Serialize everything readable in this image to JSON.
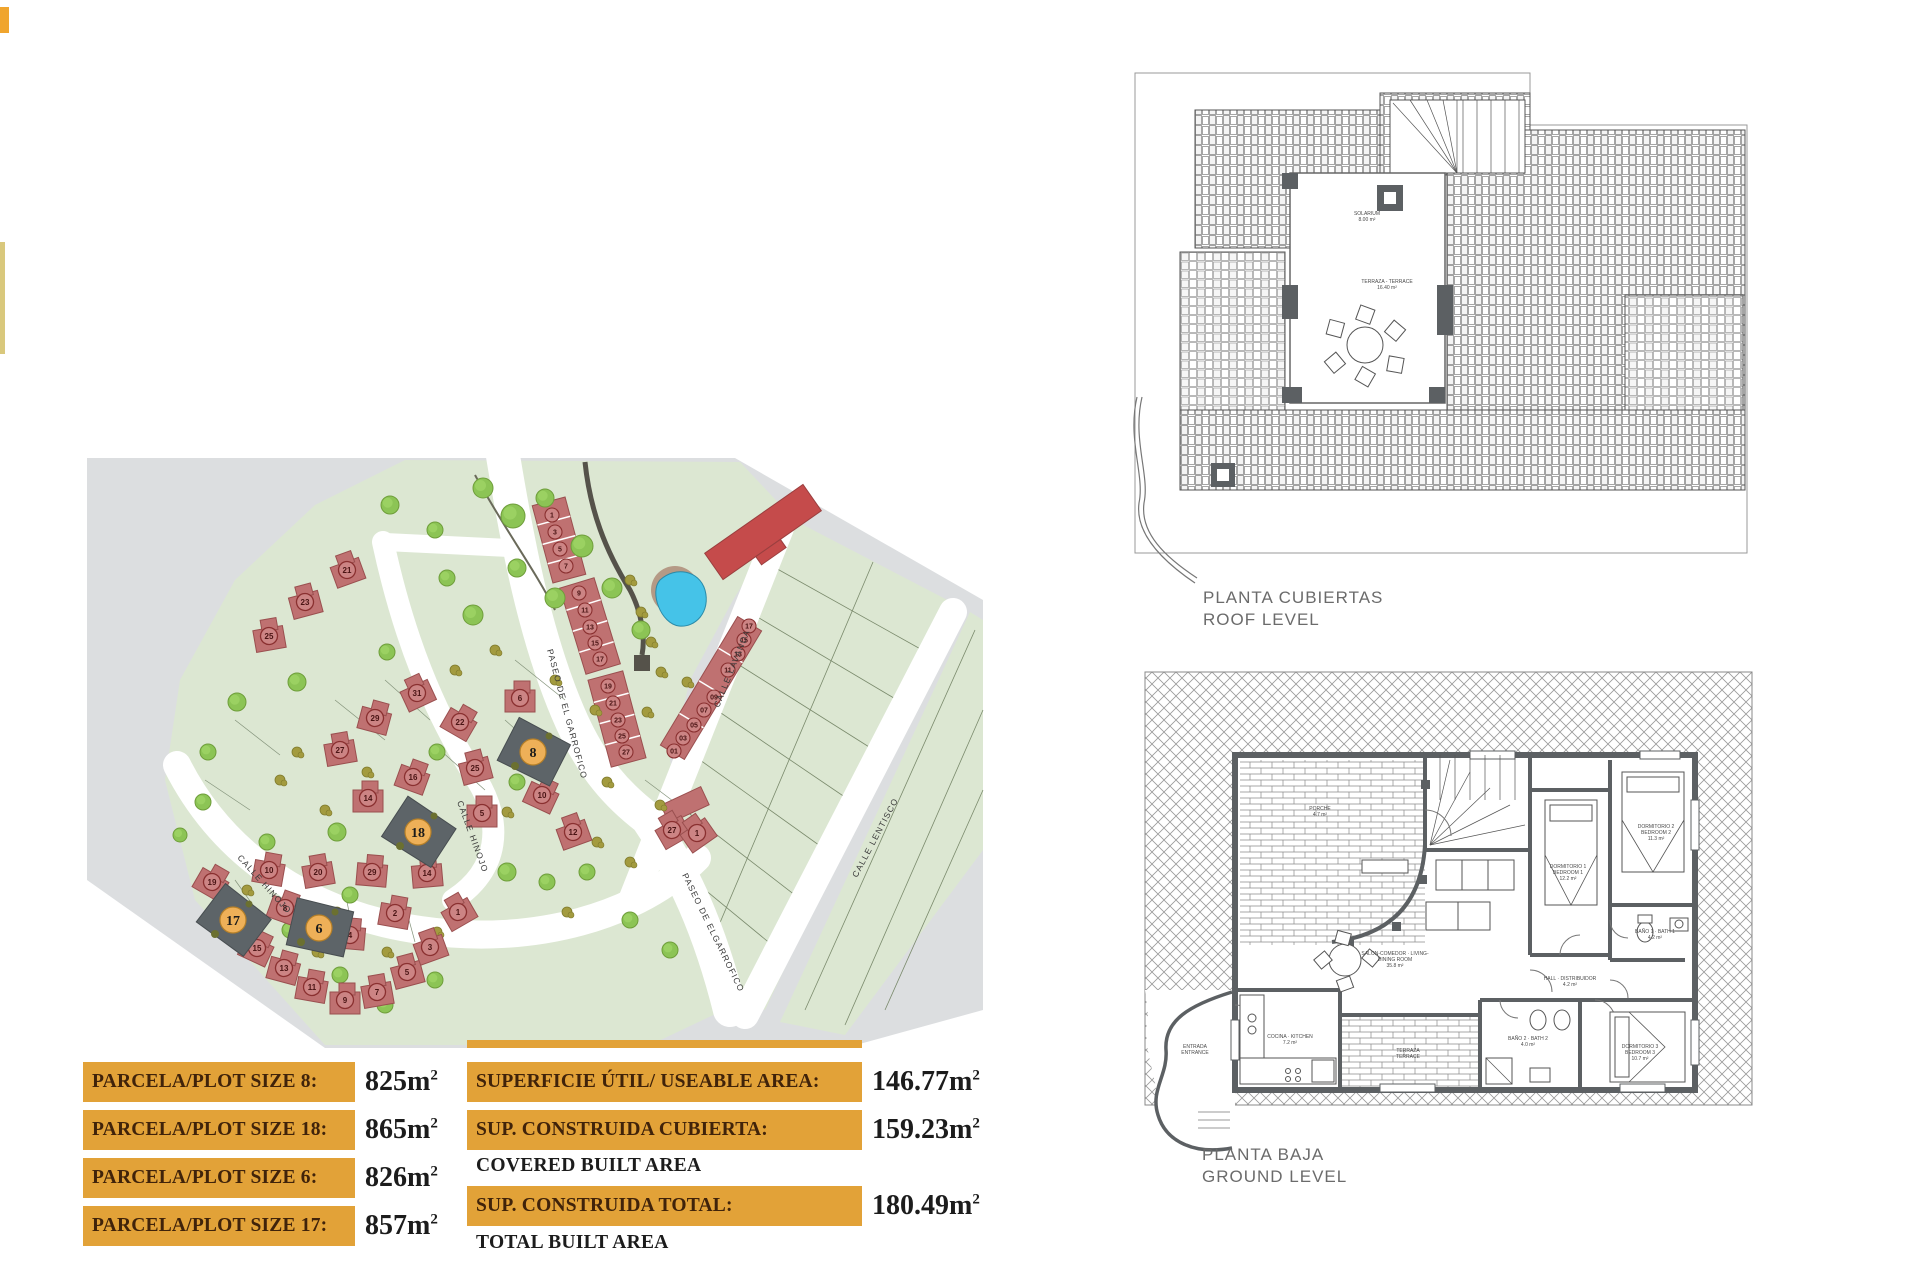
{
  "colors": {
    "orange": "#e2a238",
    "map_gray": "#dcdee0",
    "plot_green": "#dce7d2",
    "street_white": "#ffffff",
    "house_red": "#bf7171",
    "house_red_dark": "#9a4f4f",
    "number_ring": "#8a3030",
    "number_fill": "#cc8484",
    "highlight_gray": "#5d6468",
    "highlight_orange": "#eeb058",
    "pool_blue": "#45c3e8",
    "deck_tan": "#b59a86",
    "tree_green": "#8cc455",
    "tree_green_dark": "#6f9e3b",
    "shrub_olive": "#a39b3f",
    "wall_gray": "#5c6063",
    "park_path": "#55524a"
  },
  "site_plan": {
    "streets": [
      {
        "label": "PASEO DE EL GARROFICO",
        "x": 462,
        "y": 200,
        "rot": 75
      },
      {
        "label": "PASEO DE ELGARROFICO",
        "x": 597,
        "y": 425,
        "rot": 64
      },
      {
        "label": "CALLE LAVANDA",
        "x": 634,
        "y": 258,
        "rot": -68
      },
      {
        "label": "CALLE LENTISCO",
        "x": 772,
        "y": 428,
        "rot": -62
      },
      {
        "label": "CALLE HINOJO",
        "x": 152,
        "y": 408,
        "rot": 48
      },
      {
        "label": "CALLE HINOJO",
        "x": 372,
        "y": 352,
        "rot": 70
      }
    ],
    "highlighted_plots": [
      {
        "n": "8",
        "x": 448,
        "y": 302,
        "rot": 32
      },
      {
        "n": "18",
        "x": 333,
        "y": 382,
        "rot": 38
      },
      {
        "n": "6",
        "x": 234,
        "y": 478,
        "rot": 18
      },
      {
        "n": "17",
        "x": 148,
        "y": 470,
        "rot": 42
      }
    ],
    "villas": [
      {
        "n": "31",
        "x": 332,
        "y": 243,
        "rot": -25
      },
      {
        "n": "29",
        "x": 290,
        "y": 268,
        "rot": 15
      },
      {
        "n": "27",
        "x": 255,
        "y": 300,
        "rot": -10
      },
      {
        "n": "16",
        "x": 328,
        "y": 327,
        "rot": 20
      },
      {
        "n": "14",
        "x": 283,
        "y": 348,
        "rot": 0
      },
      {
        "n": "22",
        "x": 375,
        "y": 272,
        "rot": 30
      },
      {
        "n": "6",
        "x": 435,
        "y": 248,
        "rot": 0
      },
      {
        "n": "25",
        "x": 390,
        "y": 318,
        "rot": -15
      },
      {
        "n": "10",
        "x": 457,
        "y": 345,
        "rot": 25
      },
      {
        "n": "5",
        "x": 397,
        "y": 363,
        "rot": 0
      },
      {
        "n": "12",
        "x": 488,
        "y": 382,
        "rot": -20
      },
      {
        "n": "10",
        "x": 184,
        "y": 420,
        "rot": 10
      },
      {
        "n": "20",
        "x": 233,
        "y": 422,
        "rot": -10
      },
      {
        "n": "29",
        "x": 287,
        "y": 422,
        "rot": 5
      },
      {
        "n": "14",
        "x": 342,
        "y": 423,
        "rot": -5
      },
      {
        "n": "19",
        "x": 127,
        "y": 432,
        "rot": 30
      },
      {
        "n": "15",
        "x": 172,
        "y": 498,
        "rot": 25
      },
      {
        "n": "13",
        "x": 199,
        "y": 518,
        "rot": 15
      },
      {
        "n": "11",
        "x": 227,
        "y": 537,
        "rot": 10
      },
      {
        "n": "9",
        "x": 260,
        "y": 550,
        "rot": 0
      },
      {
        "n": "7",
        "x": 292,
        "y": 542,
        "rot": -10
      },
      {
        "n": "5",
        "x": 322,
        "y": 522,
        "rot": -15
      },
      {
        "n": "3",
        "x": 345,
        "y": 497,
        "rot": -20
      },
      {
        "n": "1",
        "x": 373,
        "y": 462,
        "rot": -30
      },
      {
        "n": "2",
        "x": 310,
        "y": 463,
        "rot": 10
      },
      {
        "n": "4",
        "x": 265,
        "y": 485,
        "rot": 5
      },
      {
        "n": "8",
        "x": 200,
        "y": 458,
        "rot": 20
      },
      {
        "n": "27",
        "x": 587,
        "y": 380,
        "rot": -30
      },
      {
        "n": "1",
        "x": 612,
        "y": 383,
        "rot": -35
      },
      {
        "n": "21",
        "x": 262,
        "y": 120,
        "rot": -20
      },
      {
        "n": "23",
        "x": 220,
        "y": 152,
        "rot": -15
      },
      {
        "n": "25",
        "x": 184,
        "y": 186,
        "rot": -10
      }
    ],
    "townhouse_numbers": [
      {
        "n": "1",
        "x": 467,
        "y": 65
      },
      {
        "n": "3",
        "x": 470,
        "y": 82
      },
      {
        "n": "5",
        "x": 475,
        "y": 99
      },
      {
        "n": "7",
        "x": 481,
        "y": 116
      },
      {
        "n": "9",
        "x": 494,
        "y": 143
      },
      {
        "n": "11",
        "x": 500,
        "y": 160
      },
      {
        "n": "13",
        "x": 505,
        "y": 177
      },
      {
        "n": "15",
        "x": 510,
        "y": 193
      },
      {
        "n": "17",
        "x": 515,
        "y": 209
      },
      {
        "n": "19",
        "x": 523,
        "y": 236
      },
      {
        "n": "21",
        "x": 528,
        "y": 253
      },
      {
        "n": "23",
        "x": 533,
        "y": 270
      },
      {
        "n": "25",
        "x": 537,
        "y": 286
      },
      {
        "n": "27",
        "x": 541,
        "y": 302
      },
      {
        "n": "17",
        "x": 664,
        "y": 176
      },
      {
        "n": "15",
        "x": 659,
        "y": 190
      },
      {
        "n": "13",
        "x": 653,
        "y": 204
      },
      {
        "n": "11",
        "x": 643,
        "y": 220
      },
      {
        "n": "09",
        "x": 629,
        "y": 247
      },
      {
        "n": "07",
        "x": 619,
        "y": 260
      },
      {
        "n": "05",
        "x": 609,
        "y": 275
      },
      {
        "n": "03",
        "x": 598,
        "y": 288
      },
      {
        "n": "01",
        "x": 589,
        "y": 301
      }
    ],
    "trees": [
      [
        398,
        38,
        10
      ],
      [
        428,
        66,
        12
      ],
      [
        460,
        48,
        9
      ],
      [
        497,
        96,
        11
      ],
      [
        527,
        138,
        10
      ],
      [
        556,
        180,
        9
      ],
      [
        470,
        148,
        10
      ],
      [
        432,
        118,
        9
      ],
      [
        388,
        165,
        10
      ],
      [
        362,
        128,
        8
      ],
      [
        305,
        55,
        9
      ],
      [
        350,
        80,
        8
      ],
      [
        152,
        252,
        9
      ],
      [
        123,
        302,
        8
      ],
      [
        212,
        232,
        9
      ],
      [
        302,
        202,
        8
      ],
      [
        252,
        382,
        9
      ],
      [
        182,
        392,
        8
      ],
      [
        352,
        302,
        8
      ],
      [
        422,
        422,
        9
      ],
      [
        462,
        432,
        8
      ],
      [
        502,
        422,
        8
      ],
      [
        118,
        352,
        8
      ],
      [
        265,
        445,
        8
      ],
      [
        432,
        332,
        8
      ],
      [
        95,
        385,
        7
      ],
      [
        545,
        470,
        8
      ],
      [
        585,
        500,
        8
      ],
      [
        300,
        555,
        8
      ],
      [
        350,
        530,
        8
      ],
      [
        255,
        525,
        8
      ],
      [
        205,
        480,
        8
      ]
    ],
    "shrubs": [
      [
        162,
        440
      ],
      [
        252,
        462
      ],
      [
        332,
        402
      ],
      [
        422,
        362
      ],
      [
        522,
        332
      ],
      [
        562,
        262
      ],
      [
        602,
        232
      ],
      [
        212,
        302
      ],
      [
        282,
        322
      ],
      [
        382,
        262
      ],
      [
        442,
        282
      ],
      [
        302,
        502
      ],
      [
        352,
        482
      ],
      [
        232,
        502
      ],
      [
        482,
        462
      ],
      [
        512,
        392
      ],
      [
        575,
        355
      ],
      [
        545,
        412
      ],
      [
        470,
        230
      ],
      [
        510,
        260
      ],
      [
        410,
        200
      ],
      [
        370,
        220
      ],
      [
        330,
        250
      ],
      [
        290,
        350
      ],
      [
        240,
        360
      ],
      [
        195,
        330
      ],
      [
        545,
        130
      ],
      [
        556,
        162
      ],
      [
        566,
        192
      ],
      [
        576,
        222
      ]
    ]
  },
  "roof_plan": {
    "title_es": "PLANTA CUBIERTAS",
    "title_en": "ROOF LEVEL",
    "labels": [
      {
        "x": 242,
        "y": 170,
        "lines": [
          "SOLARIUM",
          "8.00 m²"
        ]
      },
      {
        "x": 262,
        "y": 238,
        "lines": [
          "TERRAZA - TERRACE",
          "16.40 m²"
        ]
      }
    ]
  },
  "ground_plan": {
    "title_es": "PLANTA BAJA",
    "title_en": "GROUND LEVEL",
    "labels": [
      {
        "x": 255,
        "y": 295,
        "lines": [
          "SALON-COMEDOR · LIVING-",
          "DINING ROOM",
          "35.8 m²"
        ]
      },
      {
        "x": 428,
        "y": 208,
        "lines": [
          "DORMITORIO 1",
          "BEDROOM 1",
          "12.2 m²"
        ]
      },
      {
        "x": 516,
        "y": 168,
        "lines": [
          "DORMITORIO 2",
          "BEDROOM 2",
          "11.3 m²"
        ]
      },
      {
        "x": 515,
        "y": 273,
        "lines": [
          "BAÑO 1 · BATH 1",
          "4.2 m²"
        ]
      },
      {
        "x": 430,
        "y": 320,
        "lines": [
          "HALL · DISTRIBUIDOR",
          "4.2 m²"
        ]
      },
      {
        "x": 388,
        "y": 380,
        "lines": [
          "BAÑO 2 · BATH 2",
          "4.0 m²"
        ]
      },
      {
        "x": 500,
        "y": 388,
        "lines": [
          "DORMITORIO 3",
          "BEDROOM 3",
          "10.7 m²"
        ]
      },
      {
        "x": 150,
        "y": 378,
        "lines": [
          "COCINA · KITCHEN",
          "7.2 m²"
        ]
      },
      {
        "x": 268,
        "y": 392,
        "lines": [
          "TERRAZA",
          "TERRACE"
        ]
      },
      {
        "x": 55,
        "y": 388,
        "lines": [
          "ENTRADA",
          "ENTRANCE"
        ]
      },
      {
        "x": 180,
        "y": 150,
        "lines": [
          "PORCHE",
          "4.7 m²"
        ]
      }
    ]
  },
  "plot_table": {
    "unit": "m",
    "sup": "2",
    "rows": [
      {
        "label": "PARCELA/PLOT SIZE 8:",
        "value": "825"
      },
      {
        "label": "PARCELA/PLOT SIZE 18:",
        "value": "865"
      },
      {
        "label": "PARCELA/PLOT SIZE 6:",
        "value": "826"
      },
      {
        "label": "PARCELA/PLOT SIZE 17:",
        "value": "857"
      }
    ]
  },
  "area_table": {
    "unit": "m",
    "sup": "2",
    "rows": [
      {
        "label": "SUPERFICIE ÚTIL/ USEABLE AREA:",
        "value": "146.77",
        "type": "orange"
      },
      {
        "label": "SUP. CONSTRUIDA CUBIERTA:",
        "value": "159.23",
        "type": "orange"
      },
      {
        "label": "COVERED BUILT AREA",
        "value": "",
        "type": "plain"
      },
      {
        "label": "SUP. CONSTRUIDA TOTAL:",
        "value": "180.49",
        "type": "orange"
      },
      {
        "label": "TOTAL BUILT AREA",
        "value": "",
        "type": "plain"
      }
    ]
  }
}
